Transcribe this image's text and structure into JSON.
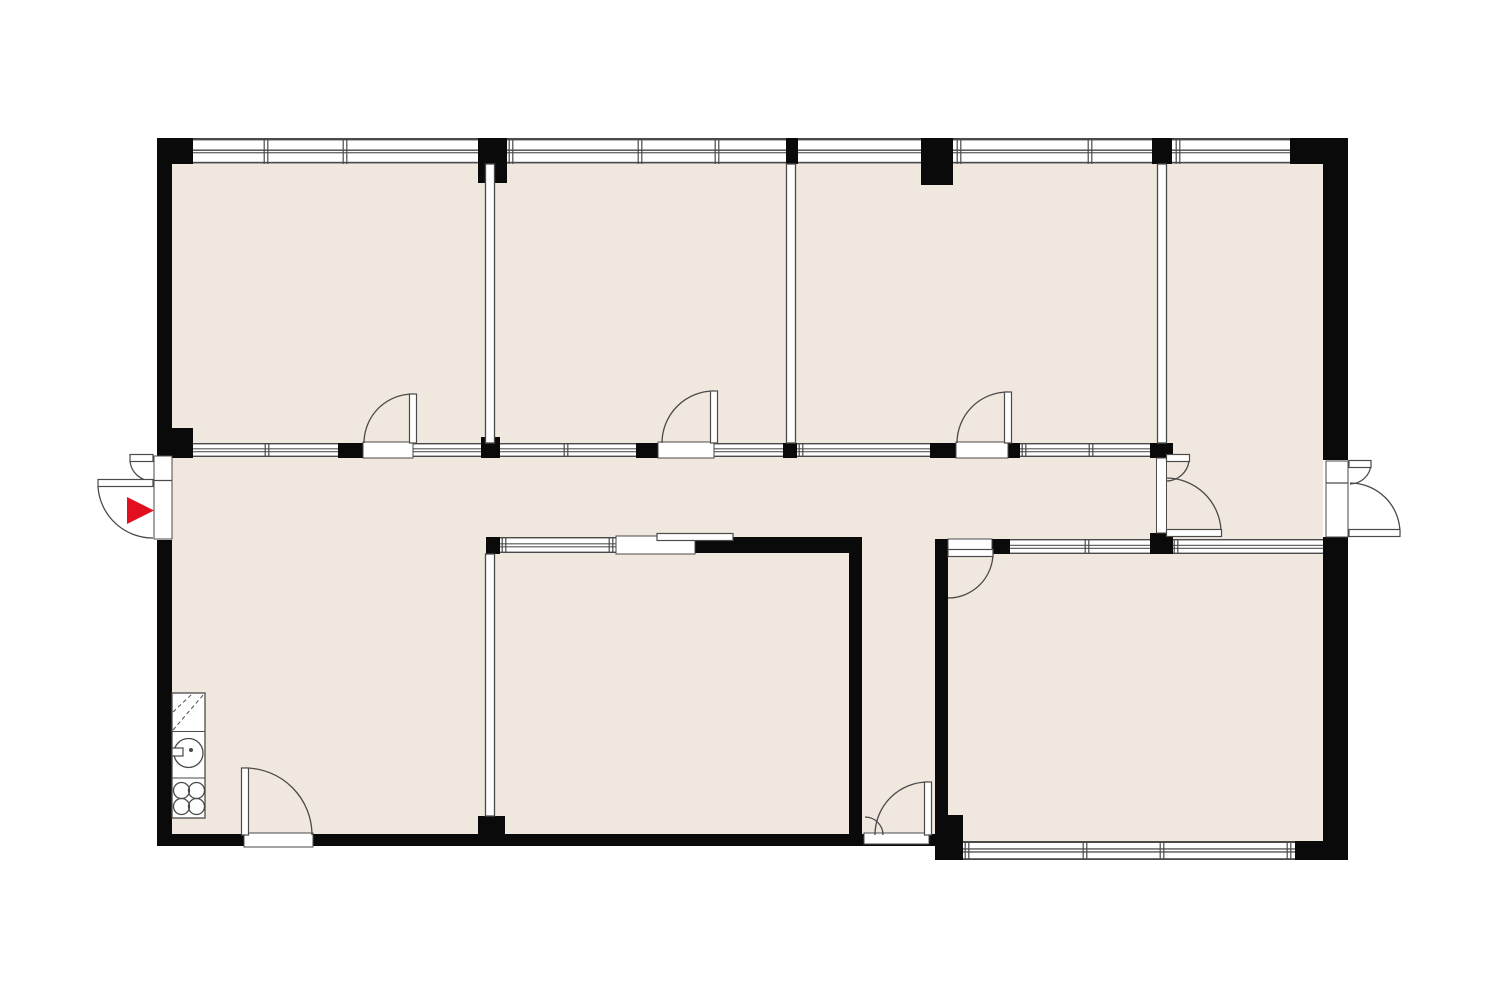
{
  "palette": {
    "exterior": "#ffffff",
    "floor": "#f0e7de",
    "wall": "#0a0a0a",
    "line": "#4a4a4a",
    "glass": "#ffffff",
    "accent_red": "#e2101e"
  },
  "entry_marker": {
    "icon": "entry-arrow-icon",
    "direction": "right",
    "color": "#e2101e",
    "points": "127,497 154,510.5 127,524"
  },
  "plan": {
    "canvas": {
      "width": 1500,
      "height": 1000
    },
    "floors": [
      {
        "name": "floor-main",
        "x": 172,
        "y": 164,
        "w": 1151,
        "h": 671
      },
      {
        "name": "floor-bottom-right-room",
        "x": 948,
        "y": 554,
        "w": 375,
        "h": 288
      }
    ],
    "bands": [
      {
        "name": "window-band-top",
        "x": 192,
        "y": 138,
        "w": 1098,
        "h": 26,
        "lines": [
          [
            0,
            2.4
          ],
          [
            11.5,
            1.4
          ],
          [
            14.2,
            1.1
          ],
          [
            23.8,
            1.7
          ]
        ],
        "mullions": [
          266,
          345,
          511,
          640,
          717,
          959,
          1090,
          1178
        ]
      },
      {
        "name": "glazed-band-corridor",
        "x": 193,
        "y": 443,
        "w": 957,
        "h": 14,
        "lines": [
          [
            0,
            1.4
          ],
          [
            5.3,
            1.05
          ],
          [
            8.2,
            1.05
          ],
          [
            12.6,
            1.4
          ]
        ],
        "mullions": [
          267,
          566,
          801,
          1024,
          1091
        ]
      },
      {
        "name": "glazed-band-midroom-top",
        "x": 500,
        "y": 537,
        "w": 116,
        "h": 16,
        "lines": [
          [
            0,
            1.4
          ],
          [
            6.3,
            1.05
          ],
          [
            9.3,
            1.05
          ],
          [
            14.6,
            1.4
          ]
        ],
        "mullions": [
          504,
          611
        ]
      },
      {
        "name": "glazed-band-bottomright-top-a",
        "x": 1010,
        "y": 539,
        "w": 140,
        "h": 15,
        "lines": [
          [
            0,
            1.4
          ],
          [
            5.8,
            1.05
          ],
          [
            8.8,
            1.05
          ],
          [
            13.6,
            1.4
          ]
        ],
        "mullions": [
          1087
        ]
      },
      {
        "name": "glazed-band-bottomright-top-b",
        "x": 1173,
        "y": 539,
        "w": 150,
        "h": 15,
        "lines": [
          [
            0,
            1.4
          ],
          [
            5.8,
            1.05
          ],
          [
            8.8,
            1.05
          ],
          [
            13.6,
            1.4
          ]
        ],
        "mullions": [
          1176
        ]
      },
      {
        "name": "window-band-bottom",
        "x": 963,
        "y": 841,
        "w": 332,
        "h": 19,
        "lines": [
          [
            0,
            2.0
          ],
          [
            7.3,
            1.3
          ],
          [
            10.3,
            1.3
          ],
          [
            17.2,
            1.8
          ]
        ],
        "mullions": [
          967,
          1085,
          1162,
          1289
        ]
      }
    ],
    "walls": [
      {
        "name": "wall-left-upper",
        "x": 157,
        "y": 138,
        "w": 15,
        "h": 317
      },
      {
        "name": "wall-left-lower",
        "x": 157,
        "y": 540,
        "w": 15,
        "h": 306
      },
      {
        "name": "wall-corner-top-left",
        "x": 157,
        "y": 138,
        "w": 36,
        "h": 26
      },
      {
        "name": "wall-corner-top-right",
        "x": 1290,
        "y": 138,
        "w": 58,
        "h": 26
      },
      {
        "name": "wall-right-upper",
        "x": 1323,
        "y": 138,
        "w": 25,
        "h": 322
      },
      {
        "name": "wall-right-lower",
        "x": 1323,
        "y": 537,
        "w": 25,
        "h": 323
      },
      {
        "name": "wall-bottom",
        "x": 157,
        "y": 834,
        "w": 778,
        "h": 12
      },
      {
        "name": "wall-step-block",
        "x": 935,
        "y": 815,
        "w": 28,
        "h": 45
      },
      {
        "name": "wall-corner-bottom-right",
        "x": 1295,
        "y": 841,
        "w": 53,
        "h": 19
      },
      {
        "name": "wall-midroom-top",
        "x": 695,
        "y": 537,
        "w": 167,
        "h": 16
      },
      {
        "name": "wall-midroom-right",
        "x": 849,
        "y": 537,
        "w": 13,
        "h": 306
      },
      {
        "name": "wall-vestibule-right",
        "x": 935,
        "y": 539,
        "w": 13,
        "h": 276
      },
      {
        "name": "pier-top-1",
        "x": 478,
        "y": 138,
        "w": 29,
        "h": 45
      },
      {
        "name": "pier-top-2",
        "x": 786,
        "y": 138,
        "w": 12,
        "h": 26
      },
      {
        "name": "column-top",
        "x": 921,
        "y": 138,
        "w": 32,
        "h": 47
      },
      {
        "name": "pier-top-3",
        "x": 1152,
        "y": 138,
        "w": 20,
        "h": 26
      },
      {
        "name": "post-corridor-left",
        "x": 157,
        "y": 428,
        "w": 36,
        "h": 30
      },
      {
        "name": "post-corridor-1",
        "x": 338,
        "y": 443,
        "w": 25,
        "h": 15
      },
      {
        "name": "post-partition-1",
        "x": 481,
        "y": 437,
        "w": 19,
        "h": 21
      },
      {
        "name": "post-corridor-2",
        "x": 636,
        "y": 443,
        "w": 22,
        "h": 15
      },
      {
        "name": "post-partition-2",
        "x": 783,
        "y": 443,
        "w": 14,
        "h": 15
      },
      {
        "name": "post-corridor-3",
        "x": 930,
        "y": 443,
        "w": 26,
        "h": 15
      },
      {
        "name": "post-corridor-4",
        "x": 1008,
        "y": 443,
        "w": 12,
        "h": 15
      },
      {
        "name": "post-partition-3",
        "x": 1150,
        "y": 443,
        "w": 23,
        "h": 15
      },
      {
        "name": "post-midroom-left",
        "x": 486,
        "y": 537,
        "w": 14,
        "h": 17
      },
      {
        "name": "post-bottomright-door",
        "x": 992,
        "y": 539,
        "w": 18,
        "h": 15
      },
      {
        "name": "post-partition-3-lower",
        "x": 1150,
        "y": 533,
        "w": 23,
        "h": 21
      },
      {
        "name": "pier-partition-4-bottom",
        "x": 478,
        "y": 816,
        "w": 27,
        "h": 19
      }
    ],
    "partitions": [
      {
        "name": "partition-room1-room2",
        "x": 485.5,
        "y": 164,
        "w": 9,
        "h": 279
      },
      {
        "name": "partition-room2-room3",
        "x": 786.5,
        "y": 164,
        "w": 9,
        "h": 279
      },
      {
        "name": "partition-room3-lobby",
        "x": 1157.5,
        "y": 164,
        "w": 9,
        "h": 279
      },
      {
        "name": "partition-midroom-left",
        "x": 485.5,
        "y": 554,
        "w": 9,
        "h": 262
      }
    ],
    "openings": [
      {
        "name": "door-opening-room1",
        "x": 363,
        "y": 442,
        "w": 50,
        "h": 16
      },
      {
        "name": "door-opening-room2",
        "x": 658,
        "y": 442,
        "w": 56,
        "h": 16
      },
      {
        "name": "door-opening-room3",
        "x": 956,
        "y": 442,
        "w": 52,
        "h": 16
      },
      {
        "name": "door-opening-bottomright",
        "x": 948,
        "y": 539,
        "w": 44,
        "h": 15
      },
      {
        "name": "sliding-door-opening",
        "x": 616,
        "y": 536,
        "w": 79,
        "h": 18
      },
      {
        "name": "door-opening-lobby",
        "x": 1156.5,
        "y": 458,
        "w": 10,
        "h": 75
      },
      {
        "name": "entrance-frame-left",
        "x": 154,
        "y": 456,
        "w": 18,
        "h": 83
      },
      {
        "name": "entrance-frame-right",
        "x": 1326,
        "y": 461,
        "w": 22,
        "h": 76
      },
      {
        "name": "door-opening-bottom-left",
        "x": 244,
        "y": 833,
        "w": 69,
        "h": 14
      },
      {
        "name": "door-opening-vestibule",
        "x": 864,
        "y": 833,
        "w": 65,
        "h": 11
      }
    ],
    "frame_lines": [
      {
        "name": "entrance-left-divider",
        "x1": 154,
        "y1": 480.5,
        "x2": 172,
        "y2": 480.5
      },
      {
        "name": "entrance-right-divider",
        "x1": 1326,
        "y1": 483,
        "x2": 1348,
        "y2": 483
      }
    ],
    "door_arcs": [
      {
        "name": "door-arc-room1",
        "d": "M 364 443 A 49 49 0 0 1 413 394"
      },
      {
        "name": "door-arc-room2",
        "d": "M 662 443 A 52 52 0 0 1 714 391"
      },
      {
        "name": "door-arc-room3",
        "d": "M 957 443 A 51 51 0 0 1 1008 392"
      },
      {
        "name": "door-arc-bottomright",
        "d": "M 993 553 A 45 45 0 0 1 948 598"
      },
      {
        "name": "door-arc-bottom-left",
        "d": "M 245 768 A 67 67 0 0 1 312 835"
      },
      {
        "name": "door-arc-vestibule-large",
        "d": "M 875 835 A 53 53 0 0 1 928 782"
      },
      {
        "name": "door-arc-vestibule-small",
        "d": "M 883 835 A 18 18 0 0 0 865 817"
      },
      {
        "name": "door-arc-entrance-left-small",
        "d": "M 130 461 A 22 22 0 0 0 152 481"
      },
      {
        "name": "door-arc-entrance-left-large",
        "d": "M 98 487 A 55 55 0 0 0 153 538"
      },
      {
        "name": "door-arc-entrance-right-small",
        "d": "M 1371 464 A 21 21 0 0 1 1350 484"
      },
      {
        "name": "door-arc-entrance-right-large",
        "d": "M 1350 483 A 50 50 0 0 1 1400 533"
      },
      {
        "name": "door-arc-lobby-small",
        "d": "M 1189 461 A 23 23 0 0 1 1166 481"
      },
      {
        "name": "door-arc-lobby-large",
        "d": "M 1221 530 A 55 55 0 0 0 1166 478"
      }
    ],
    "door_leaves": [
      {
        "name": "door-leaf-room1",
        "x": 409.5,
        "y": 394,
        "w": 7,
        "h": 49
      },
      {
        "name": "door-leaf-room2",
        "x": 710.5,
        "y": 391,
        "w": 7,
        "h": 52
      },
      {
        "name": "door-leaf-room3",
        "x": 1004.5,
        "y": 392,
        "w": 7,
        "h": 51
      },
      {
        "name": "door-leaf-bottomright",
        "x": 948,
        "y": 549.5,
        "w": 45,
        "h": 7
      },
      {
        "name": "door-leaf-bottom-left",
        "x": 241.5,
        "y": 768,
        "w": 7,
        "h": 67
      },
      {
        "name": "door-leaf-vestibule",
        "x": 924.5,
        "y": 782,
        "w": 7,
        "h": 53
      },
      {
        "name": "sliding-door-leaf",
        "x": 657,
        "y": 533.5,
        "w": 76,
        "h": 7
      },
      {
        "name": "entrance-left-leaf-small",
        "x": 130,
        "y": 454.5,
        "w": 23,
        "h": 7
      },
      {
        "name": "entrance-left-leaf-large",
        "x": 98,
        "y": 479.5,
        "w": 55,
        "h": 7
      },
      {
        "name": "entrance-right-leaf-small",
        "x": 1349,
        "y": 460.5,
        "w": 22,
        "h": 7
      },
      {
        "name": "entrance-right-leaf-large",
        "x": 1349,
        "y": 529.5,
        "w": 51,
        "h": 7
      },
      {
        "name": "lobby-door-leaf-small",
        "x": 1166.5,
        "y": 454.5,
        "w": 23,
        "h": 7
      },
      {
        "name": "lobby-door-leaf-large",
        "x": 1166.5,
        "y": 529.5,
        "w": 55,
        "h": 7
      }
    ],
    "kitchen": {
      "outline": {
        "name": "kitchen-counter",
        "x": 172,
        "y": 693,
        "w": 33,
        "h": 125
      },
      "dividers": [
        {
          "name": "kitchen-divider-1",
          "x1": 172,
          "y1": 731.5,
          "x2": 205,
          "y2": 731.5
        },
        {
          "name": "kitchen-divider-2",
          "x1": 172,
          "y1": 778,
          "x2": 205,
          "y2": 778
        }
      ],
      "dashes": [
        {
          "name": "cabinet-dashed-symbol-1",
          "d": "M 173 730 L 204 694"
        },
        {
          "name": "cabinet-dashed-symbol-2",
          "d": "M 173 712 L 192 694"
        }
      ],
      "sink": {
        "name": "sink-icon",
        "cx": 188.5,
        "cy": 753,
        "r": 14.5,
        "dot_cx": 191,
        "dot_cy": 750,
        "dot_r": 2
      },
      "tap": {
        "name": "tap-icon",
        "x": 172,
        "y": 748,
        "w": 11,
        "h": 8
      },
      "burner_r": 8,
      "burners": [
        [
          181.5,
          790.5
        ],
        [
          196.5,
          790.5
        ],
        [
          181.5,
          806.5
        ],
        [
          196.5,
          806.5
        ]
      ]
    }
  }
}
